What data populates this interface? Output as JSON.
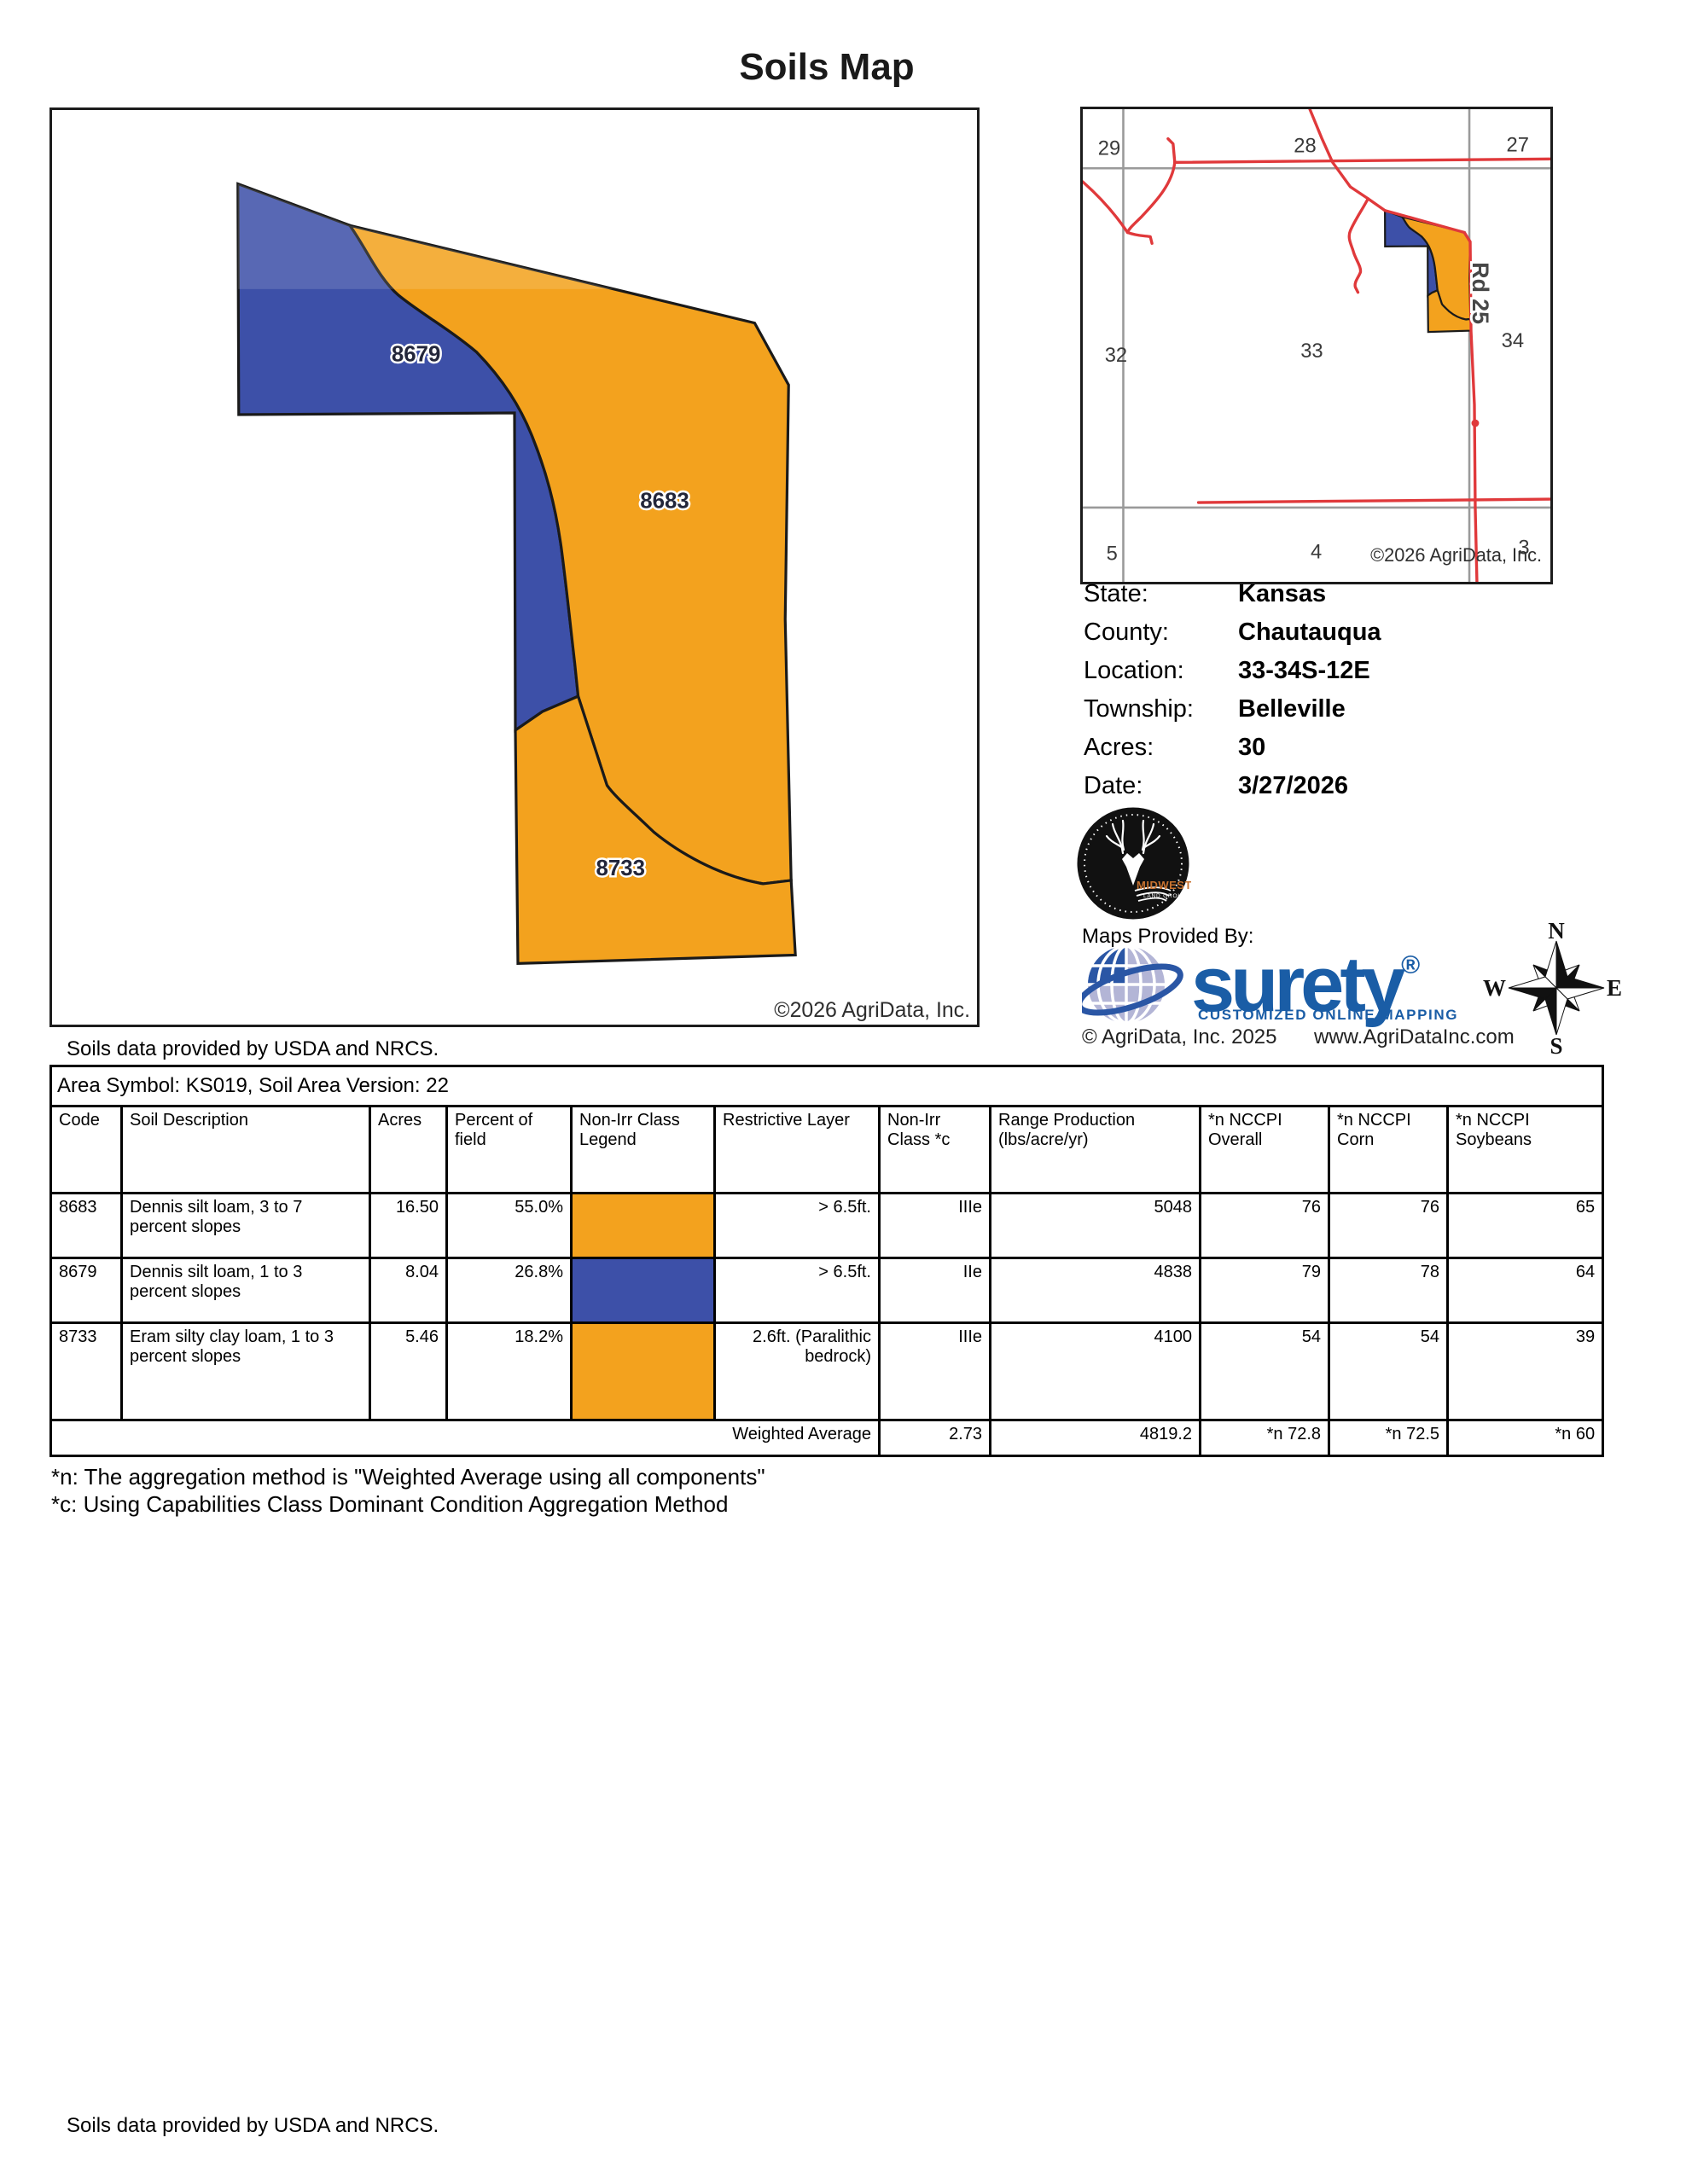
{
  "title": "Soils Map",
  "map": {
    "region_labels": [
      "8679",
      "8683",
      "8733"
    ],
    "copyright": "©2026 AgriData, Inc.",
    "source_note": "Soils data provided by USDA and NRCS."
  },
  "locator": {
    "sections": [
      "29",
      "28",
      "27",
      "32",
      "33",
      "34",
      "5",
      "4",
      "3"
    ],
    "road_label": "Rd 25",
    "copyright": "©2026 AgriData, Inc."
  },
  "info": {
    "rows": [
      {
        "label": "State:",
        "value": "Kansas"
      },
      {
        "label": "County:",
        "value": "Chautauqua"
      },
      {
        "label": "Location:",
        "value": "33-34S-12E"
      },
      {
        "label": "Township:",
        "value": "Belleville"
      },
      {
        "label": "Acres:",
        "value": "30"
      },
      {
        "label": "Date:",
        "value": "3/27/2026"
      }
    ]
  },
  "provider": {
    "maps_provided_by": "Maps Provided By:",
    "brand": "surety",
    "brand_reg": "®",
    "tagline": "CUSTOMIZED ONLINE MAPPING",
    "copyright": "© AgriData, Inc. 2025",
    "website": "www.AgriDataInc.com",
    "midwest_top": "MIDWEST",
    "midwest_bottom": "LAND GROUP"
  },
  "compass": {
    "n": "N",
    "e": "E",
    "s": "S",
    "w": "W"
  },
  "table": {
    "area_symbol": "Area Symbol: KS019, Soil Area Version: 22",
    "headers": [
      "Code",
      "Soil Description",
      "Acres",
      "Percent of field",
      "Non-Irr Class Legend",
      "Restrictive Layer",
      "Non-Irr Class *c",
      "Range Production (lbs/acre/yr)",
      "*n NCCPI Overall",
      "*n NCCPI Corn",
      "*n NCCPI Soybeans"
    ],
    "rows": [
      {
        "code": "8683",
        "description": "Dennis silt loam, 3 to 7 percent slopes",
        "acres": "16.50",
        "percent": "55.0%",
        "legend_color": "#F3A21E",
        "restrictive": "> 6.5ft.",
        "nonirr_class": "IIIe",
        "range_production": "5048",
        "nccpi_overall": "76",
        "nccpi_corn": "76",
        "nccpi_soybeans": "65"
      },
      {
        "code": "8679",
        "description": "Dennis silt loam, 1 to 3 percent slopes",
        "acres": "8.04",
        "percent": "26.8%",
        "legend_color": "#3D50A8",
        "restrictive": "> 6.5ft.",
        "nonirr_class": "IIe",
        "range_production": "4838",
        "nccpi_overall": "79",
        "nccpi_corn": "78",
        "nccpi_soybeans": "64"
      },
      {
        "code": "8733",
        "description": "Eram silty clay loam, 1 to 3 percent slopes",
        "acres": "5.46",
        "percent": "18.2%",
        "legend_color": "#F3A21E",
        "restrictive": "2.6ft. (Paralithic bedrock)",
        "nonirr_class": "IIIe",
        "range_production": "4100",
        "nccpi_overall": "54",
        "nccpi_corn": "54",
        "nccpi_soybeans": "39"
      }
    ],
    "footer": {
      "label": "Weighted Average",
      "nonirr_class": "2.73",
      "range_production": "4819.2",
      "nccpi_overall": "*n 72.8",
      "nccpi_corn": "*n 72.5",
      "nccpi_soybeans": "*n 60"
    }
  },
  "footnotes": [
    "*n: The aggregation method is \"Weighted Average using all components\"",
    "*c: Using Capabilities Class Dominant Condition Aggregation Method"
  ],
  "bottom_note": "Soils data provided by USDA and NRCS.",
  "colors": {
    "orange": "#F3A21E",
    "blue": "#3D50A8",
    "road_red": "#E0393B",
    "section_gray": "#9A9A9A",
    "brand_blue": "#1A5DA6"
  }
}
